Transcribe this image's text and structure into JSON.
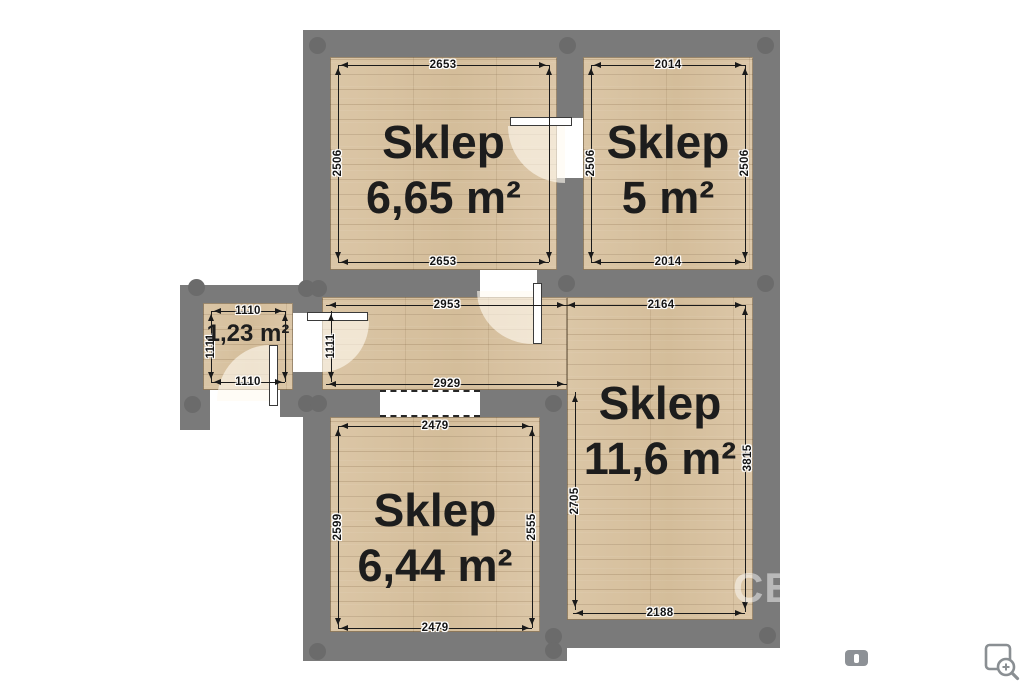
{
  "watermark": "CE",
  "rooms": {
    "room1": {
      "name": "Sklep",
      "area": "6,65 m²",
      "dim_top": "2653",
      "dim_bottom": "2653",
      "dim_left": "2506"
    },
    "room2": {
      "name": "Sklep",
      "area": "5 m²",
      "dim_top": "2014",
      "dim_bottom": "2014",
      "dim_left": "2506",
      "dim_right": "2506"
    },
    "vestibule": {
      "area": "1,23 m²",
      "dim_top": "1110",
      "dim_bottom": "1110",
      "dim_left": "1111",
      "dim_right": "1111"
    },
    "room3": {
      "name": "Sklep",
      "area": "11,6 m²",
      "dim_top": "2164",
      "dim_bottom": "2188",
      "dim_left": "2705",
      "dim_right": "3815"
    },
    "room4": {
      "name": "Sklep",
      "area": "6,44 m²",
      "dim_top": "2479",
      "dim_bottom": "2479",
      "dim_left": "2599",
      "dim_right": "2555"
    }
  },
  "corridor": {
    "dim_top": "2953",
    "dim_bottom": "2929"
  },
  "icons": {
    "badge": "photo-badge-icon",
    "zoom": "zoom-preview-icon"
  },
  "colors": {
    "wall": "#7a7a7a",
    "post": "#6b6b6b",
    "floor": "#d8c2a1",
    "dim_text": "#141414",
    "room_text": "#1d1d1d",
    "icon_gray": "#8a8f93"
  }
}
